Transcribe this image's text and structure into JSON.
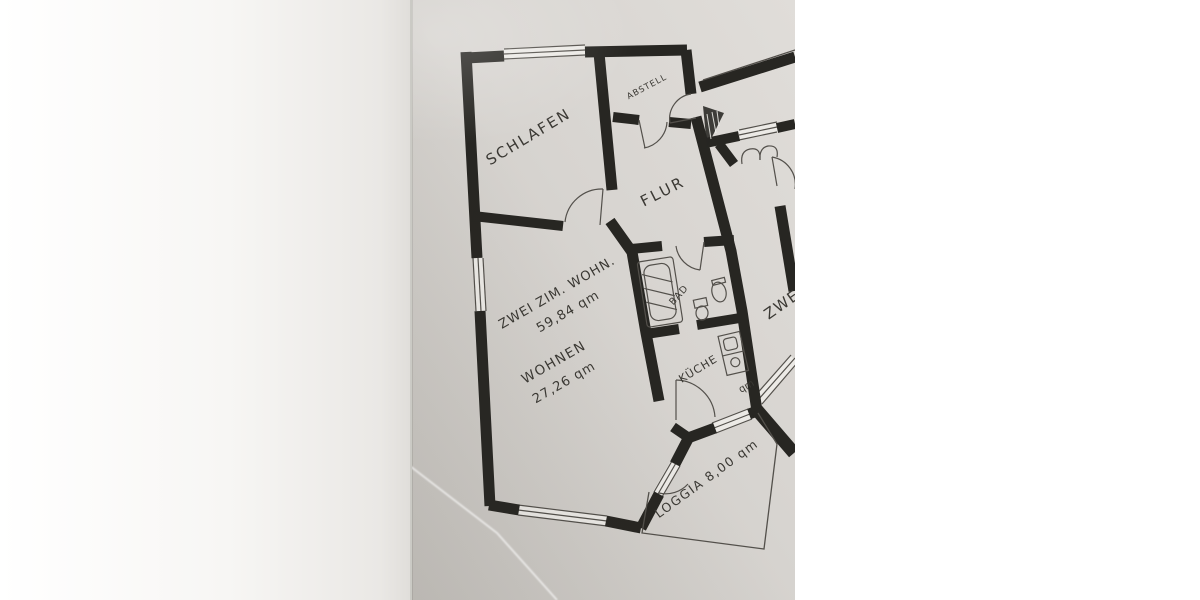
{
  "photo": {
    "description": "hand-drawn apartment floor plan, photographed on paper",
    "colors": {
      "background": "#ffffff",
      "paper": "#d7d4d0",
      "paper_light": "#eceae6",
      "wall": "#272622",
      "line": "#53504b",
      "ink": "#3a3833"
    }
  },
  "apartment": {
    "title": {
      "line1": "ZWEI ZIM. WOHN.",
      "line2": "59,84 qm"
    },
    "rooms": {
      "schlafen": {
        "label": "SCHLAFEN"
      },
      "abstell": {
        "label": "ABSTELL"
      },
      "flur": {
        "label": "FLUR"
      },
      "bad": {
        "label": "BAD"
      },
      "kueche": {
        "label": "KÜCHE"
      },
      "wohnen": {
        "label": "WOHNEN",
        "area": "27,26 qm"
      },
      "loggia": {
        "label": "LOGGIA",
        "area": "8,00 qm"
      }
    }
  },
  "neighbor_apartment": {
    "label_partial": "ZWEI",
    "area_unit_partial": "qm"
  }
}
